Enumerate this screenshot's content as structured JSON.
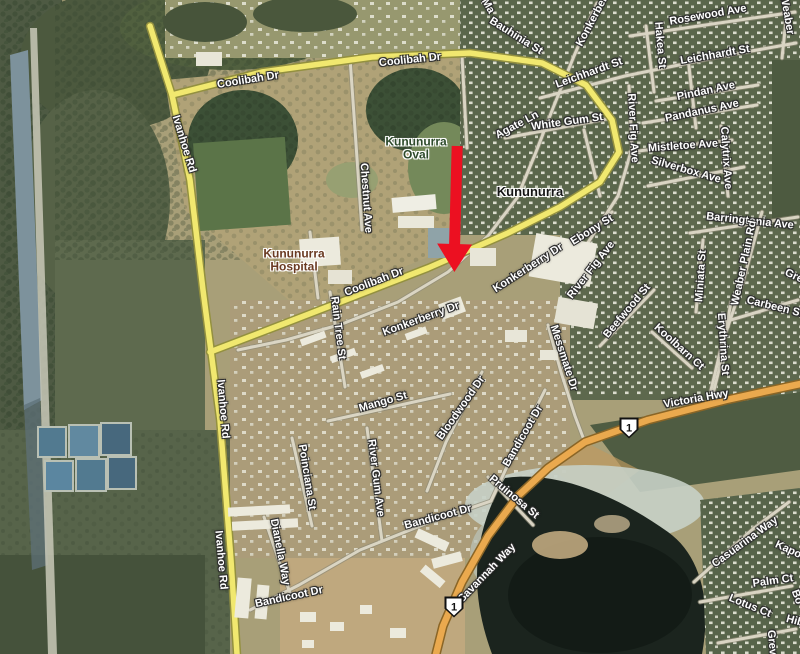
{
  "map": {
    "locality": "Kununurra",
    "poi_labels": [
      {
        "lines": [
          "Kununurra",
          "Oval"
        ],
        "x": 416,
        "y": 148,
        "color": "#2d4a2b",
        "size": 12
      },
      {
        "lines": [
          "Kununurra"
        ],
        "x": 530,
        "y": 192,
        "color": "#151515",
        "size": 13
      },
      {
        "lines": [
          "Kununurra",
          "Hospital"
        ],
        "x": 294,
        "y": 260,
        "color": "#6a3a22",
        "size": 12
      }
    ],
    "street_labels": [
      {
        "text": "Coolibah Dr",
        "x": 248,
        "y": 80,
        "rot": -9
      },
      {
        "text": "Coolibah Dr",
        "x": 410,
        "y": 60,
        "rot": -6
      },
      {
        "text": "Coolibah Dr",
        "x": 374,
        "y": 282,
        "rot": -21
      },
      {
        "text": "Ivanhoe Rd",
        "x": 184,
        "y": 144,
        "rot": 73
      },
      {
        "text": "Ivanhoe Rd",
        "x": 223,
        "y": 409,
        "rot": 85
      },
      {
        "text": "Ivanhoe Rd",
        "x": 221,
        "y": 560,
        "rot": 85
      },
      {
        "text": "Ma",
        "x": 488,
        "y": 6,
        "rot": 60
      },
      {
        "text": "Bauhinia St",
        "x": 516,
        "y": 36,
        "rot": 32
      },
      {
        "text": "Konkerberry Dr",
        "x": 598,
        "y": 10,
        "rot": -62
      },
      {
        "text": "Rosewood Ave",
        "x": 708,
        "y": 15,
        "rot": -10
      },
      {
        "text": "Weaber",
        "x": 787,
        "y": 15,
        "rot": 80
      },
      {
        "text": "Hakea St",
        "x": 660,
        "y": 45,
        "rot": 85
      },
      {
        "text": "Leichhardt St",
        "x": 589,
        "y": 73,
        "rot": -20
      },
      {
        "text": "Leichhardt St",
        "x": 715,
        "y": 55,
        "rot": -10
      },
      {
        "text": "Pindan Ave",
        "x": 706,
        "y": 91,
        "rot": -12
      },
      {
        "text": "Pandanus Ave",
        "x": 702,
        "y": 111,
        "rot": -12
      },
      {
        "text": "White Gum St",
        "x": 567,
        "y": 122,
        "rot": -8
      },
      {
        "text": "Agate Ln",
        "x": 517,
        "y": 125,
        "rot": -28
      },
      {
        "text": "Mistletoe Ave",
        "x": 683,
        "y": 146,
        "rot": -4
      },
      {
        "text": "River Fig Ave",
        "x": 633,
        "y": 128,
        "rot": 87
      },
      {
        "text": "Calytrix Ave",
        "x": 726,
        "y": 158,
        "rot": 86
      },
      {
        "text": "Silverbox Ave",
        "x": 686,
        "y": 170,
        "rot": 16
      },
      {
        "text": "Chestnut Ave",
        "x": 366,
        "y": 198,
        "rot": 86
      },
      {
        "text": "Barringtonia Ave",
        "x": 750,
        "y": 221,
        "rot": 6
      },
      {
        "text": "Weaber Plain Rd",
        "x": 744,
        "y": 263,
        "rot": -78
      },
      {
        "text": "Miniata St",
        "x": 701,
        "y": 276,
        "rot": -86
      },
      {
        "text": "Gre",
        "x": 794,
        "y": 276,
        "rot": 25
      },
      {
        "text": "Ebony St",
        "x": 592,
        "y": 230,
        "rot": -32
      },
      {
        "text": "River Fig Ave",
        "x": 591,
        "y": 270,
        "rot": -52
      },
      {
        "text": "Konkerberry Dr",
        "x": 528,
        "y": 268,
        "rot": -33
      },
      {
        "text": "Konkerberry Dr",
        "x": 421,
        "y": 319,
        "rot": -20
      },
      {
        "text": "Rain Tree St",
        "x": 338,
        "y": 328,
        "rot": 83
      },
      {
        "text": "Beefwood St",
        "x": 627,
        "y": 311,
        "rot": -50
      },
      {
        "text": "Carbeen St",
        "x": 775,
        "y": 307,
        "rot": 14
      },
      {
        "text": "Erythrina St",
        "x": 723,
        "y": 344,
        "rot": 86
      },
      {
        "text": "Koolbarn Ct",
        "x": 679,
        "y": 347,
        "rot": 42
      },
      {
        "text": "Messmate Dr",
        "x": 564,
        "y": 358,
        "rot": 72
      },
      {
        "text": "Victoria Hwy",
        "x": 696,
        "y": 399,
        "rot": -10
      },
      {
        "text": "Mango St",
        "x": 383,
        "y": 402,
        "rot": -16
      },
      {
        "text": "Bloodwood Dr",
        "x": 461,
        "y": 408,
        "rot": -55
      },
      {
        "text": "Bandicoot Dr",
        "x": 523,
        "y": 436,
        "rot": -60
      },
      {
        "text": "Bandicoot Dr",
        "x": 438,
        "y": 517,
        "rot": -15
      },
      {
        "text": "Bandicoot Dr",
        "x": 289,
        "y": 597,
        "rot": -12
      },
      {
        "text": "Pruinosa St",
        "x": 514,
        "y": 497,
        "rot": 40
      },
      {
        "text": "Poinciana St",
        "x": 307,
        "y": 477,
        "rot": 81
      },
      {
        "text": "River Gum Ave",
        "x": 376,
        "y": 478,
        "rot": 83
      },
      {
        "text": "Dianella Way",
        "x": 280,
        "y": 552,
        "rot": 79
      },
      {
        "text": "Savannah Way",
        "x": 487,
        "y": 573,
        "rot": -46
      },
      {
        "text": "Casuarina Way",
        "x": 745,
        "y": 542,
        "rot": -36
      },
      {
        "text": "Kapok",
        "x": 791,
        "y": 551,
        "rot": 25
      },
      {
        "text": "Palm Ct",
        "x": 773,
        "y": 581,
        "rot": -8
      },
      {
        "text": "Lotus Ct",
        "x": 750,
        "y": 606,
        "rot": 22
      },
      {
        "text": "Bo",
        "x": 797,
        "y": 597,
        "rot": 70
      },
      {
        "text": "Hib",
        "x": 795,
        "y": 621,
        "rot": 15
      },
      {
        "text": "Grevi",
        "x": 772,
        "y": 644,
        "rot": 85
      }
    ],
    "route_shields": [
      {
        "number": "1",
        "x": 629,
        "y": 428
      },
      {
        "number": "1",
        "x": 454,
        "y": 607
      }
    ],
    "annotation": {
      "arrow_color": "#ec1021"
    },
    "road_colors": {
      "main_road_fill": "#f1e86f",
      "highway_fill": "#eaa94e"
    }
  }
}
